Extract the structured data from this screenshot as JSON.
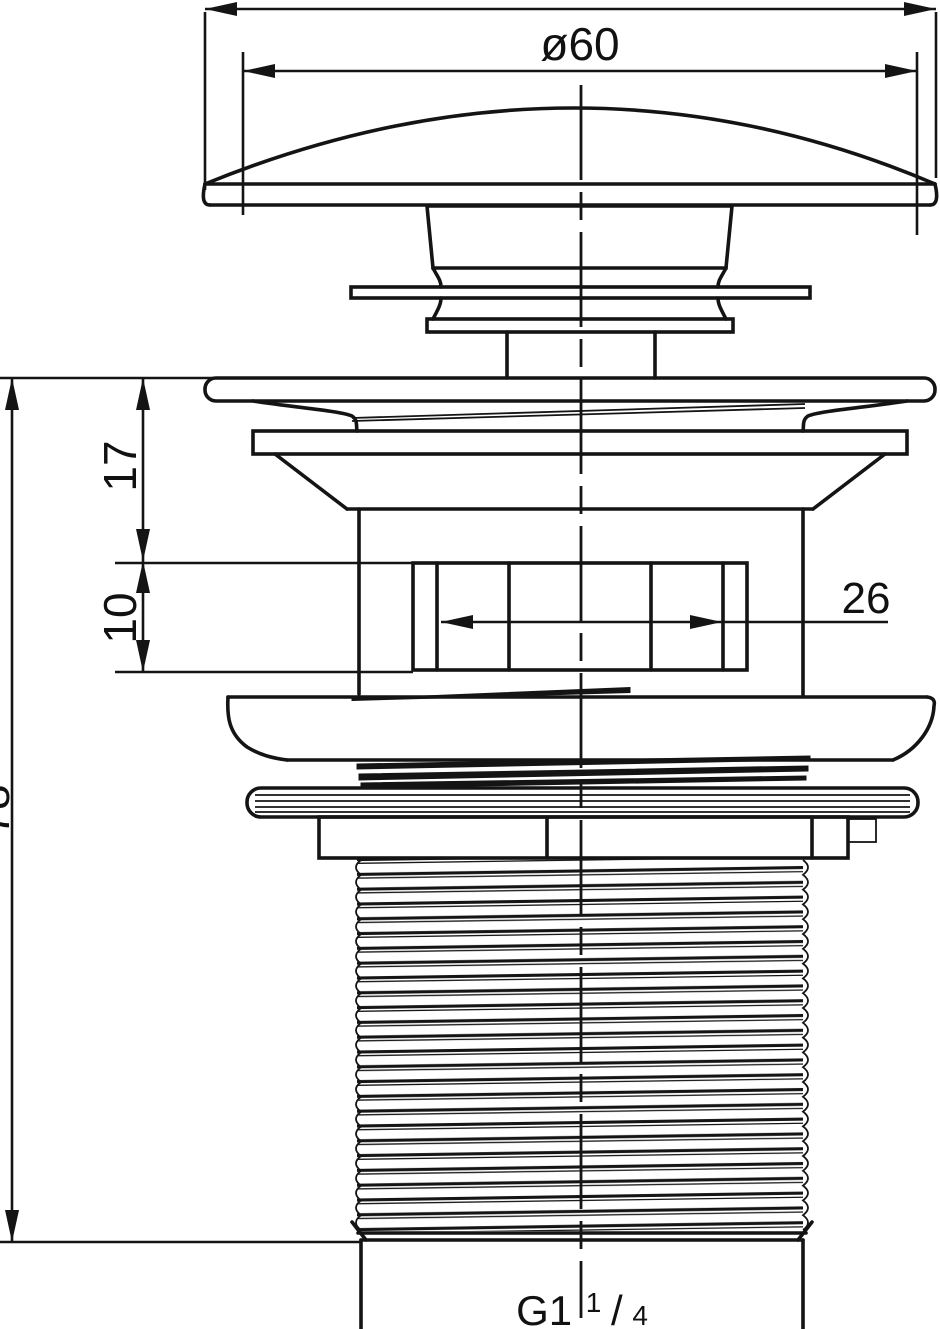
{
  "drawing": {
    "kind": "technical line drawing - push-button basin waste (pop-up drain) elevation",
    "colors": {
      "line": "#141414",
      "background": "#ffffff"
    },
    "dimensions": {
      "cap_diameter": "ø60",
      "upper_flange_height": "17",
      "slot_section_height": "10",
      "slot_width": "26",
      "overall_height": "78",
      "thread_label": {
        "prefix": "G1",
        "numerator": "1",
        "slash": "/",
        "denominator": "4"
      }
    }
  }
}
